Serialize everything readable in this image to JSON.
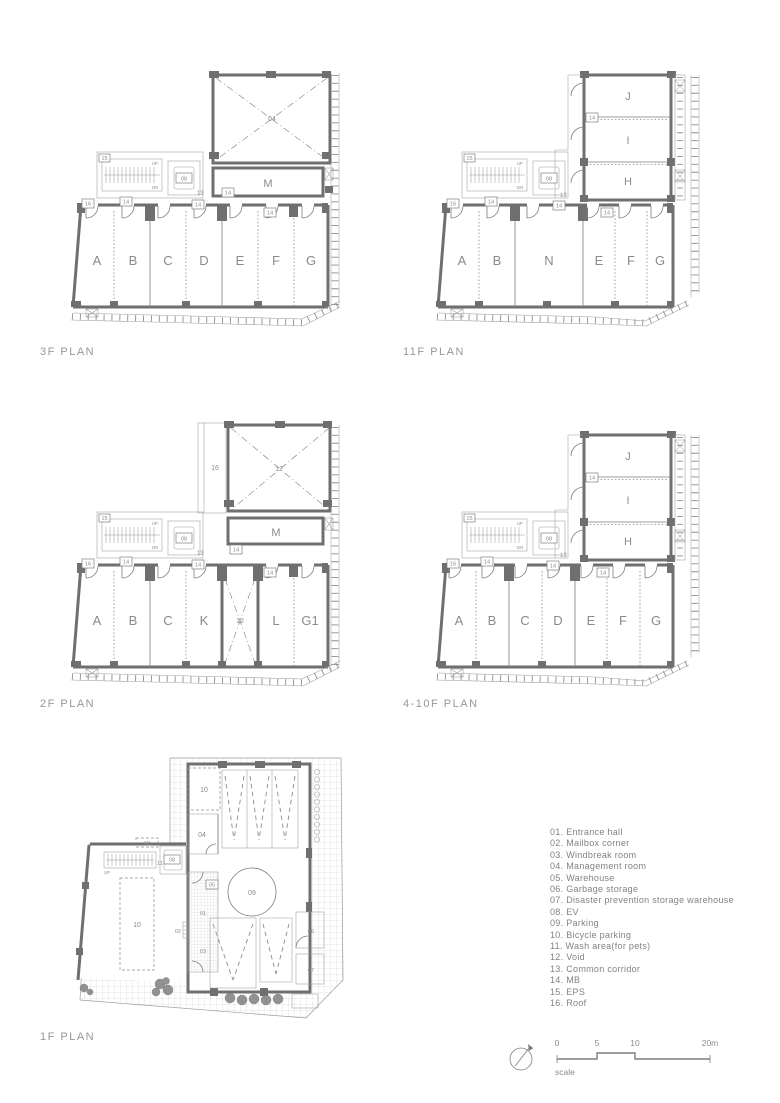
{
  "plans": {
    "f3": {
      "title": "3F PLAN",
      "rooms": [
        "A",
        "B",
        "C",
        "D",
        "E",
        "F",
        "G"
      ],
      "m": "M",
      "roof": "04",
      "corridor": "13",
      "mb": "14",
      "ev": "08",
      "eps": "15",
      "corner": "16",
      "up": "UP",
      "dn": "DN"
    },
    "f11": {
      "title": "11F PLAN",
      "rooms": [
        "A",
        "B",
        "N",
        "E",
        "F",
        "G"
      ],
      "stack": [
        "J",
        "I",
        "H"
      ],
      "corridor": "13",
      "mb": "14",
      "ev": "08",
      "eps": "15",
      "corner": "16",
      "up": "UP",
      "dn": "DN"
    },
    "f2": {
      "title": "2F PLAN",
      "rooms": [
        "A",
        "B",
        "C",
        "K",
        "L",
        "G1"
      ],
      "void": "12",
      "strip": "16",
      "m": "M",
      "roof": "12",
      "corridor": "13",
      "mb": "14",
      "ev": "08",
      "eps": "15",
      "corner": "16",
      "up": "UP",
      "dn": "DN"
    },
    "f410": {
      "title": "4-10F PLAN",
      "rooms": [
        "A",
        "B",
        "C",
        "D",
        "E",
        "F",
        "G"
      ],
      "stack": [
        "J",
        "I",
        "H"
      ],
      "corridor": "13",
      "mb": "14",
      "ev": "08",
      "eps": "15",
      "corner": "16",
      "up": "UP",
      "dn": "DN"
    },
    "f1": {
      "title": "1F PLAN",
      "labels": {
        "bike_top": "10",
        "mgmt": "04",
        "ev": "08",
        "bike_small": "10",
        "wash": "11",
        "bike": "10",
        "entrance": "01",
        "mailbox": "02",
        "windbreak": "03",
        "warehouse": "05",
        "parking": "09",
        "garbage": "06",
        "disaster": "07",
        "up": "UP"
      }
    }
  },
  "legend": [
    "01. Entrance hall",
    "02. Mailbox corner",
    "03. Windbreak room",
    "04. Management room",
    "05. Warehouse",
    "06. Garbage storage",
    "07. Disaster prevention storage warehouse",
    "08. EV",
    "09. Parking",
    "10. Bicycle parking",
    "11. Wash area(for pets)",
    "12. Void",
    "13. Common corridor",
    "14. MB",
    "15. EPS",
    "16. Roof"
  ],
  "scale": {
    "t0": "0",
    "t5": "5",
    "t10": "10",
    "t20": "20m",
    "label": "scale"
  }
}
